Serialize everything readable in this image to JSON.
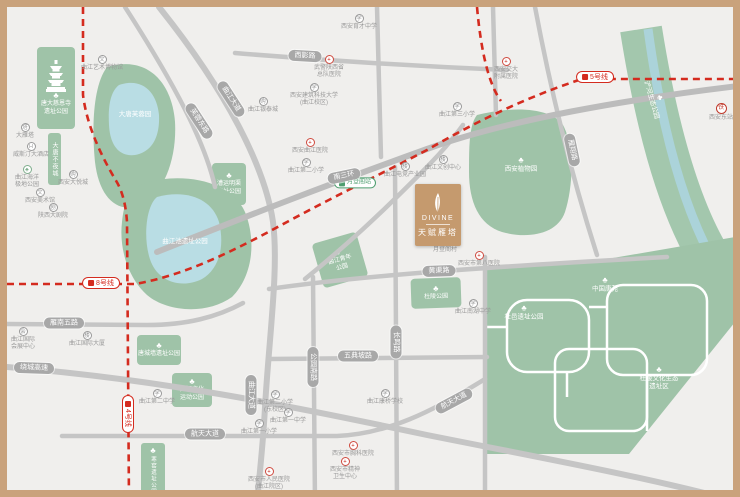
{
  "map_title": "项目区位图",
  "project": {
    "name_en": "DIVINE",
    "name_cn": "天赋雁塔",
    "logo": "feather-icon",
    "marker_color": "#c59a6e"
  },
  "colors": {
    "frame": "#c9a27c",
    "background": "#f0efed",
    "road": "#c5c5c5",
    "park_green": "#9fc3a8",
    "water_blue": "#abd3da",
    "metro_red": "#d42b1f",
    "badge_gray": "#a8a8a8",
    "poi_gray": "#9a9a9a",
    "project_tan": "#c59a6e",
    "hospital_red": "#cf4a3f",
    "station_green": "#4e9e6f"
  },
  "landmarks": {
    "pagoda_park_line1": "唐大慈恩寺",
    "pagoda_park_line2": "遗址公园",
    "strip_park": "大唐不夜城",
    "hanyao_park": "寒窑遗址公园"
  },
  "metro_badges": [
    {
      "label": "5号线",
      "x": 588,
      "y": 70,
      "rot": 0
    },
    {
      "label": "8号线",
      "x": 94,
      "y": 276,
      "rot": 0
    },
    {
      "label": "4号线",
      "x": 121,
      "y": 407,
      "rot": 90
    }
  ],
  "road_badges": [
    {
      "label": "南三环",
      "x": 337,
      "y": 169,
      "rot": -12
    },
    {
      "label": "曲江大道",
      "x": 224,
      "y": 92,
      "rot": 57
    },
    {
      "label": "芙蓉东路",
      "x": 192,
      "y": 114,
      "rot": 57
    },
    {
      "label": "西影路",
      "x": 298,
      "y": 49,
      "rot": 3
    },
    {
      "label": "雁翔路",
      "x": 565,
      "y": 143,
      "rot": 78
    },
    {
      "label": "长鸣路",
      "x": 389,
      "y": 335,
      "rot": 90
    },
    {
      "label": "公园南路",
      "x": 306,
      "y": 360,
      "rot": 90
    },
    {
      "label": "曲江大道",
      "x": 244,
      "y": 388,
      "rot": 90
    },
    {
      "label": "五典坡路",
      "x": 351,
      "y": 349,
      "rot": 0
    },
    {
      "label": "黄渠路",
      "x": 432,
      "y": 264,
      "rot": -2
    },
    {
      "label": "雁南五路",
      "x": 57,
      "y": 316,
      "rot": 0
    },
    {
      "label": "绕城高速",
      "x": 27,
      "y": 361,
      "rot": 2
    },
    {
      "label": "航天大道",
      "x": 198,
      "y": 427,
      "rot": 0
    },
    {
      "label": "航天大道",
      "x": 447,
      "y": 394,
      "rot": -28
    }
  ],
  "park_blocks": [
    {
      "x": 205,
      "y": 156,
      "w": 34,
      "h": 42,
      "rot": 0,
      "icon": true,
      "lines": [
        "漕运明渠",
        "遗址公园"
      ]
    },
    {
      "x": 310,
      "y": 230,
      "w": 46,
      "h": 46,
      "rot": -16,
      "icon": true,
      "lines": [
        "曲江青年",
        "公园"
      ]
    },
    {
      "x": 404,
      "y": 271,
      "w": 50,
      "h": 30,
      "rot": -2,
      "icon": true,
      "lines": [
        "杜陵公园"
      ]
    },
    {
      "x": 130,
      "y": 328,
      "w": 44,
      "h": 30,
      "rot": 0,
      "icon": true,
      "lines": [
        "唐城墙遗址公园"
      ]
    },
    {
      "x": 165,
      "y": 366,
      "w": 40,
      "h": 34,
      "rot": 0,
      "icon": true,
      "lines": [
        "曲江文化",
        "运动公园"
      ]
    }
  ],
  "park_labels": [
    {
      "lines": [
        "大唐芙蓉园"
      ],
      "x": 128,
      "y": 108,
      "icon": false,
      "rot": 0
    },
    {
      "lines": [
        "曲江池遗址公园"
      ],
      "x": 178,
      "y": 235,
      "icon": false,
      "rot": 0
    },
    {
      "lines": [
        "西安植物园"
      ],
      "x": 514,
      "y": 158,
      "icon": true,
      "rot": 0
    },
    {
      "lines": [
        "中国唐苑"
      ],
      "x": 598,
      "y": 278,
      "icon": true,
      "rot": 0
    },
    {
      "lines": [
        "杜邑遗址公园"
      ],
      "x": 517,
      "y": 306,
      "icon": true,
      "rot": 0
    },
    {
      "lines": [
        "杜陵文化生态",
        "遗址区"
      ],
      "x": 652,
      "y": 372,
      "icon": true,
      "rot": 0
    },
    {
      "lines": [
        "浐河生态公园"
      ],
      "x": 648,
      "y": 92,
      "icon": true,
      "rot": 74
    }
  ],
  "pois": [
    {
      "lines": [
        "曲江艺术博物馆"
      ],
      "x": 95,
      "y": 48,
      "icon": "museum"
    },
    {
      "lines": [
        "大雁塔"
      ],
      "x": 18,
      "y": 116,
      "icon": "tower"
    },
    {
      "lines": [
        "威斯汀大酒店"
      ],
      "x": 24,
      "y": 135,
      "icon": "hotel"
    },
    {
      "lines": [
        "曲江海洋",
        "极地公园"
      ],
      "x": 20,
      "y": 158,
      "icon": "tree"
    },
    {
      "lines": [
        "西安大悦城"
      ],
      "x": 66,
      "y": 163,
      "icon": "mall"
    },
    {
      "lines": [
        "西安美术馆"
      ],
      "x": 33,
      "y": 181,
      "icon": "museum"
    },
    {
      "lines": [
        "陕西大剧院"
      ],
      "x": 46,
      "y": 196,
      "icon": "theater"
    },
    {
      "lines": [
        "曲江国际",
        "会展中心"
      ],
      "x": 16,
      "y": 320,
      "icon": "expo"
    },
    {
      "lines": [
        "曲江国际大厦"
      ],
      "x": 80,
      "y": 324,
      "icon": "building"
    },
    {
      "lines": [
        "武警陕西省",
        "总队医院"
      ],
      "x": 322,
      "y": 48,
      "icon": "hospital"
    },
    {
      "lines": [
        "曲江银泰城"
      ],
      "x": 256,
      "y": 90,
      "icon": "mall"
    },
    {
      "lines": [
        "西安建筑科技大学",
        "(曲江校区)"
      ],
      "x": 307,
      "y": 76,
      "icon": "school"
    },
    {
      "lines": [
        "西安育才中学"
      ],
      "x": 352,
      "y": 7,
      "icon": "school"
    },
    {
      "lines": [
        "曲江电竞产业园"
      ],
      "x": 398,
      "y": 155,
      "icon": "building"
    },
    {
      "lines": [
        "曲江文创中心"
      ],
      "x": 436,
      "y": 148,
      "icon": "building"
    },
    {
      "lines": [
        "曲江第三小学"
      ],
      "x": 450,
      "y": 95,
      "icon": "school"
    },
    {
      "lines": [
        "西安交大",
        "附属医院"
      ],
      "x": 499,
      "y": 50,
      "icon": "hospital"
    },
    {
      "lines": [
        "月登阁村"
      ],
      "x": 438,
      "y": 240,
      "icon": "dot"
    },
    {
      "lines": [
        "西安曲江医院"
      ],
      "x": 303,
      "y": 131,
      "icon": "hospital"
    },
    {
      "lines": [
        "曲江第二小学"
      ],
      "x": 299,
      "y": 151,
      "icon": "school"
    },
    {
      "lines": [
        "曲江南湖中学"
      ],
      "x": 466,
      "y": 292,
      "icon": "school"
    },
    {
      "lines": [
        "西安市第八医院"
      ],
      "x": 472,
      "y": 244,
      "icon": "hospital"
    },
    {
      "lines": [
        "曲江第二中学"
      ],
      "x": 150,
      "y": 382,
      "icon": "school"
    },
    {
      "lines": [
        "曲江第二小学",
        "(东校区)"
      ],
      "x": 268,
      "y": 383,
      "icon": "school"
    },
    {
      "lines": [
        "曲江第一中学"
      ],
      "x": 281,
      "y": 401,
      "icon": "school"
    },
    {
      "lines": [
        "曲江第一小学"
      ],
      "x": 252,
      "y": 412,
      "icon": "school"
    },
    {
      "lines": [
        "曲江康桥学校"
      ],
      "x": 378,
      "y": 382,
      "icon": "school"
    },
    {
      "lines": [
        "西安市胸科医院"
      ],
      "x": 346,
      "y": 434,
      "icon": "hospital"
    },
    {
      "lines": [
        "西安市精神",
        "卫生中心"
      ],
      "x": 338,
      "y": 450,
      "icon": "hospital"
    },
    {
      "lines": [
        "西安市人民医院",
        "(曲江院区)"
      ],
      "x": 262,
      "y": 460,
      "icon": "hospital"
    },
    {
      "lines": [
        "西安东站"
      ],
      "x": 714,
      "y": 96,
      "icon": "rail"
    },
    {
      "lines": [
        "月登阁站"
      ],
      "x": 348,
      "y": 176,
      "icon": "metro"
    }
  ]
}
